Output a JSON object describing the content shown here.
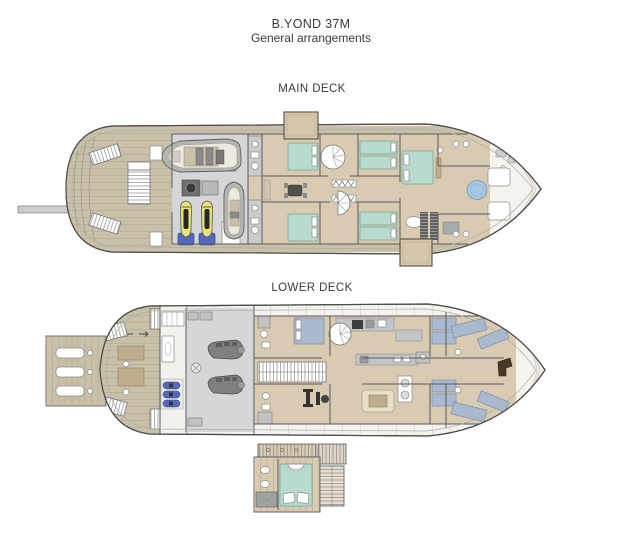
{
  "header": {
    "title": "B.YOND 37M",
    "subtitle": "General arrangements"
  },
  "decks": {
    "main": {
      "label": "MAIN DECK"
    },
    "lower": {
      "label": "LOWER DECK"
    }
  },
  "colors": {
    "ink": "#3a3a3a",
    "hull_line": "#4d4d4d",
    "hull_fill": "#f4f3ee",
    "teak": "#c9c0aa",
    "teak_line": "#a89e86",
    "wood": "#d9cbb2",
    "wood_dark": "#bfae8e",
    "gray_floor": "#d5d6d7",
    "wall": "#5a5a5a",
    "bed_green": "#b7dccf",
    "bed_blue": "#a9b9cf",
    "balcony": "#d4c7ac",
    "tub_blue": "#a6c7e2",
    "jetski_yellow": "#e9e473",
    "accent_blue": "#5568bd",
    "engine_gray": "#7f7f7f"
  }
}
